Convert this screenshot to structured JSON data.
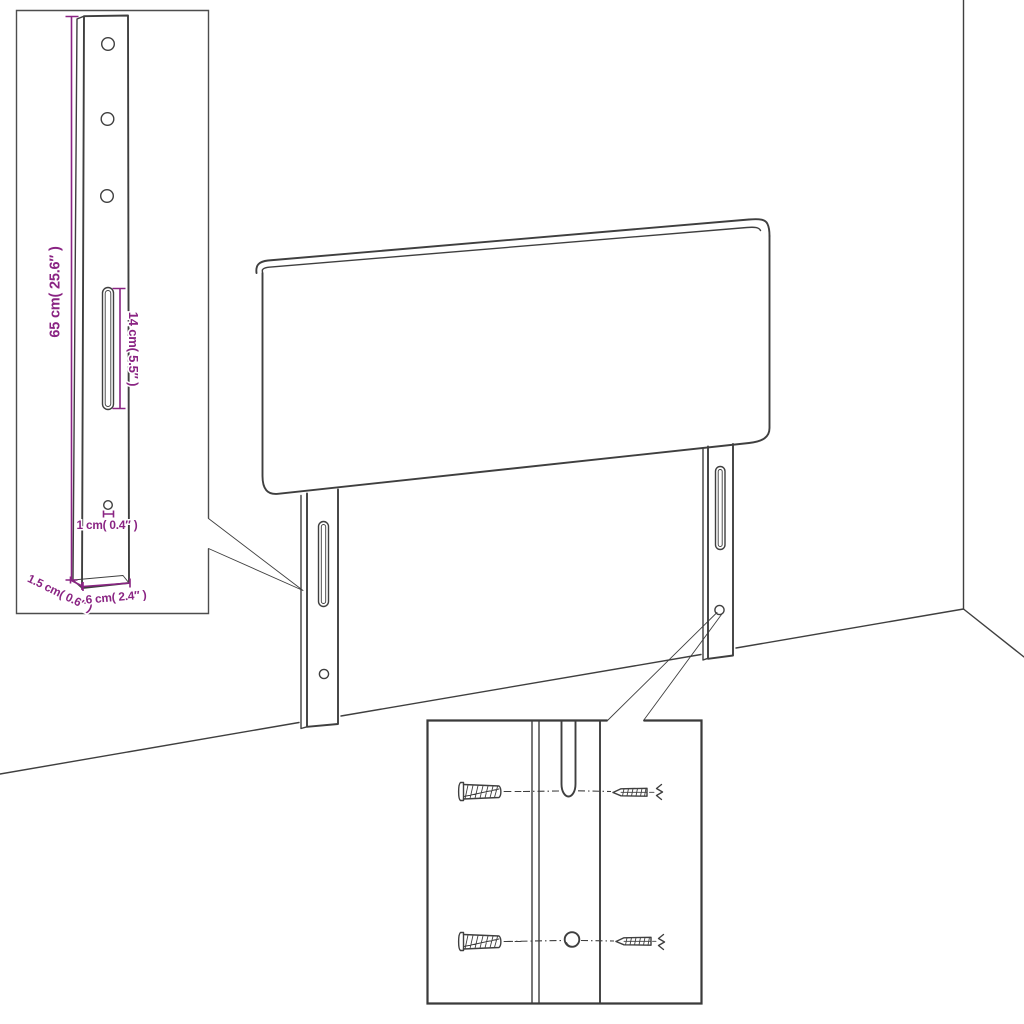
{
  "figure": {
    "type": "assembly-dimension-diagram",
    "subject": "upholstered headboard with two adjustable wall-mount legs",
    "colors": {
      "line": "#3f3f3f",
      "dimension": "#8a2483",
      "background": "#ffffff"
    }
  },
  "leg_detail": {
    "height_label": "65 cm( 25.6″ )",
    "slot_length_label": "14 cm( 5.5″ )",
    "hole_diameter_label": "1 cm( 0.4″ )",
    "thickness_label": "1.5 cm( 0.6″ )",
    "width_label": "6 cm( 2.4″ )"
  }
}
